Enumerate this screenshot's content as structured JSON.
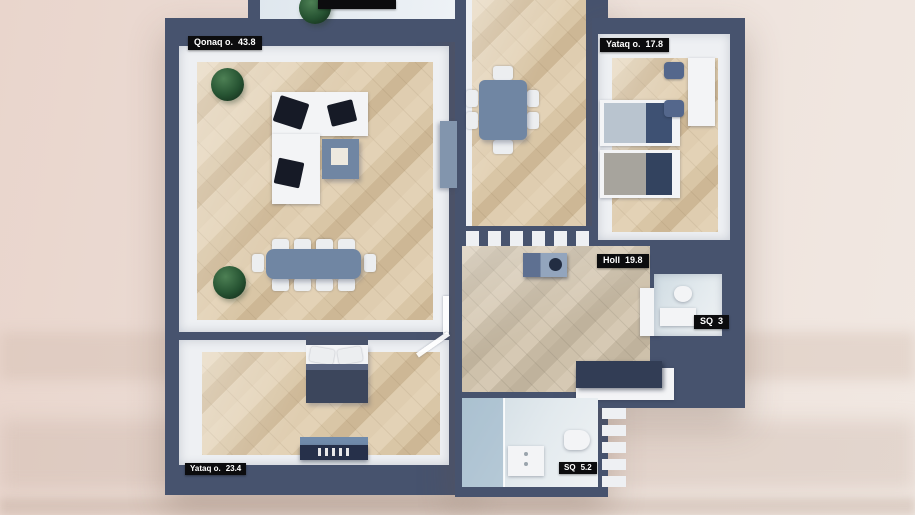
{
  "scene": {
    "description": "3D top-down apartment floor plan render",
    "language": "Azerbaijani"
  },
  "rooms": [
    {
      "name": "living-room",
      "label": "Qonaq o.",
      "area": "43.8"
    },
    {
      "name": "bedroom-top-right",
      "label": "Yataq o.",
      "area": "17.8"
    },
    {
      "name": "hall",
      "label": "Holl",
      "area": "19.8"
    },
    {
      "name": "wc-small",
      "label": "SQ",
      "area": "3"
    },
    {
      "name": "bedroom-bottom-left",
      "label": "Yataq o.",
      "area": "23.4"
    },
    {
      "name": "bathroom",
      "label": "SQ",
      "area": "5.2"
    }
  ],
  "balcony_label": "",
  "furniture": [
    "corner-sofa",
    "coffee-table",
    "long-dining-table",
    "tv-stand",
    "potted-plants",
    "dining-table-six-chairs",
    "twin-beds",
    "desk-with-chairs",
    "double-bed",
    "dresser",
    "washing-machine",
    "storage-bench",
    "wardrobe",
    "toilet",
    "sink",
    "shower-cabin",
    "radiator"
  ],
  "colors": {
    "wall": "#47536e",
    "floor_wood": "#d9c5a7",
    "floor_hall": "#cfc3ae",
    "interior_white": "#eef0f3",
    "label_bg": "#0c0c0e",
    "label_text": "#ffffff",
    "furniture_blue": "#7086a3",
    "navy": "#323d55",
    "background_left": "#e9d5cc",
    "background_right": "#f1e8e2",
    "balcony_floor": "#e6ecf1",
    "bath_floor": "#dce4e9"
  }
}
